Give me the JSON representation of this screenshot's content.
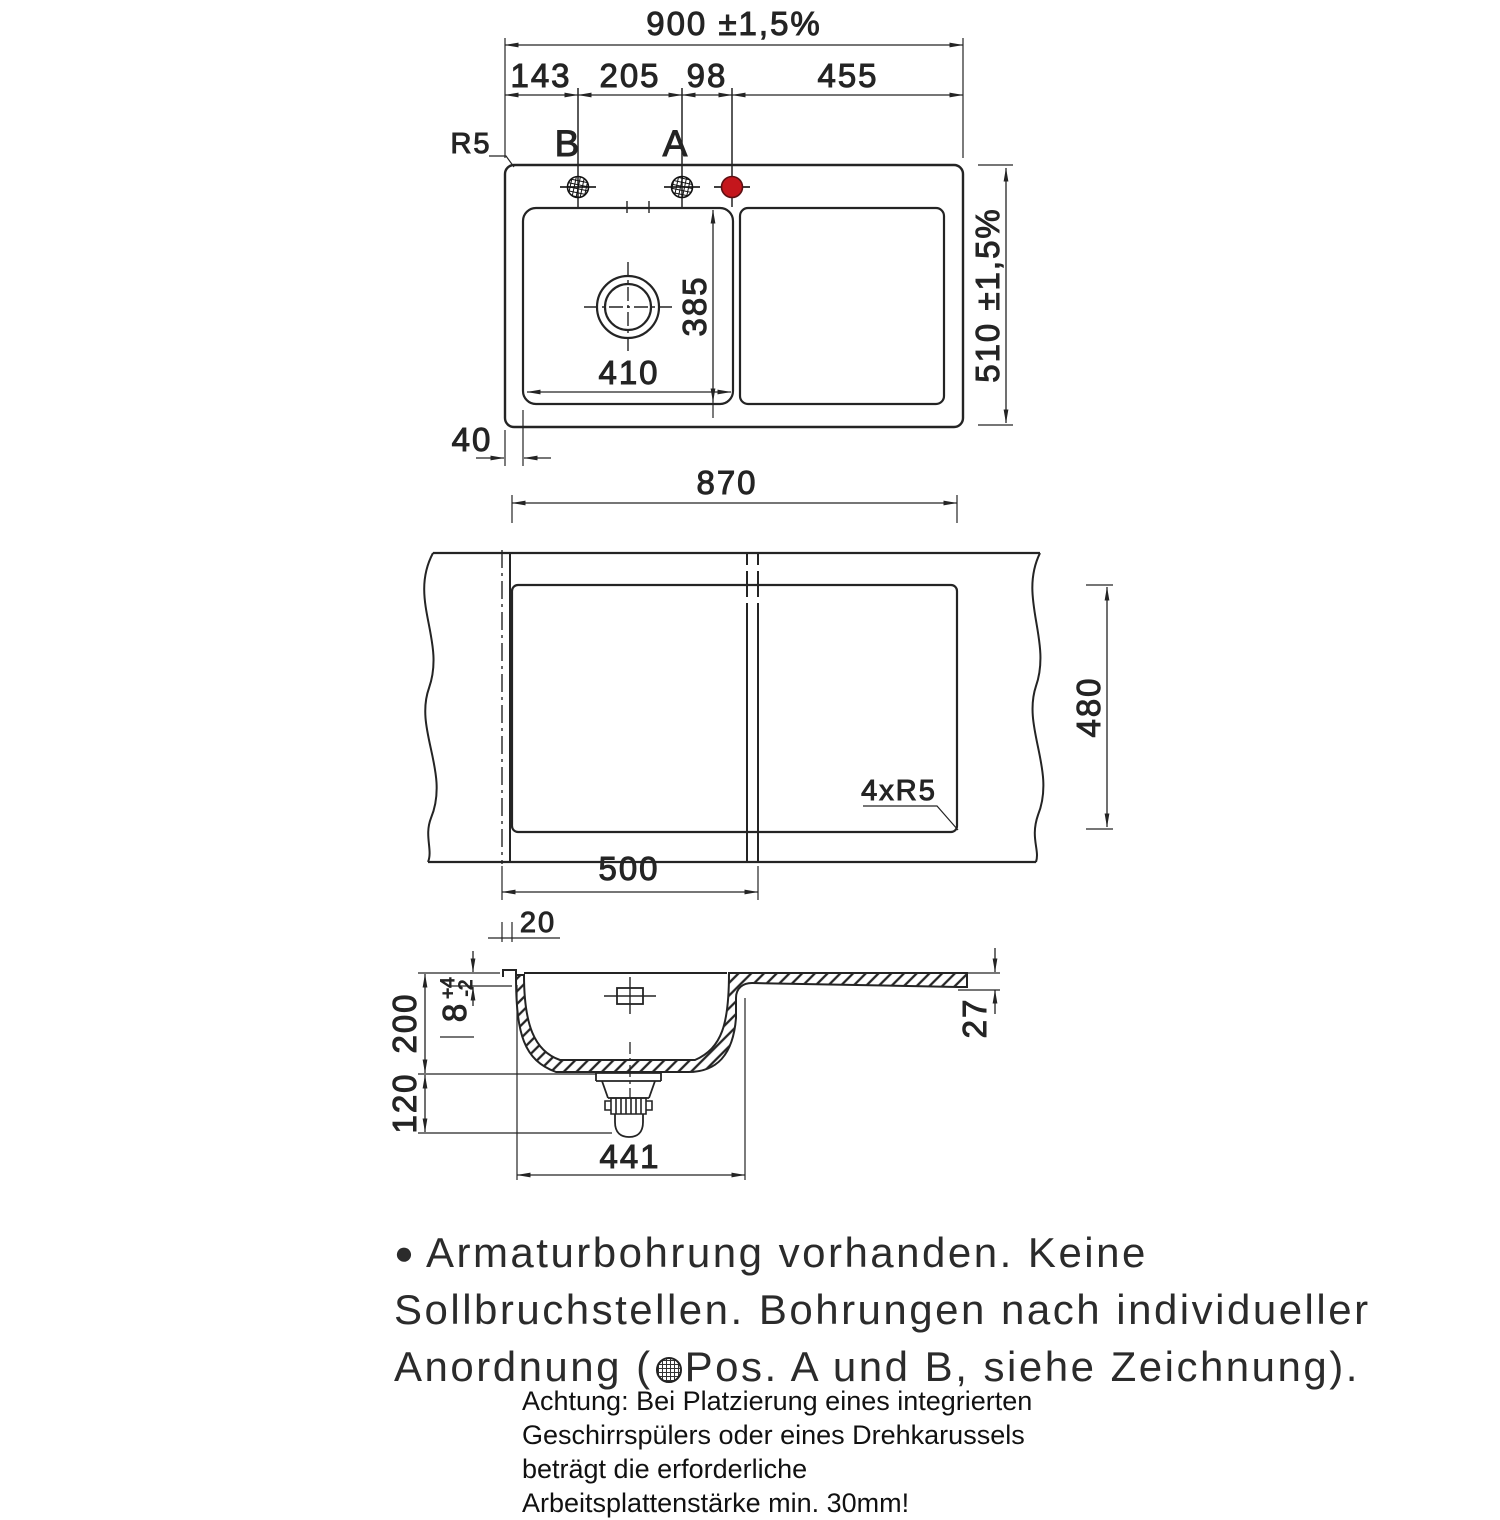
{
  "drawing": {
    "top_view": {
      "dim_overall_width": "900 ±1,5%",
      "dim_seg_1": "143",
      "dim_seg_2": "205",
      "dim_seg_3": "98",
      "dim_seg_4": "455",
      "label_radius": "R5",
      "label_hole_b": "B",
      "label_hole_a": "A",
      "dim_bowl_depth": "385",
      "dim_bowl_width": "410",
      "dim_overall_height": "510 ±1,5%",
      "dim_edge_offset": "40"
    },
    "cutout_view": {
      "dim_cutout_width": "870",
      "dim_cutout_height": "480",
      "label_corner_radius": "4xR5",
      "dim_left_width": "500",
      "dim_offset": "20"
    },
    "section_view": {
      "dim_depth": "200",
      "dim_rim": "8",
      "dim_rim_tol_plus": "+4",
      "dim_rim_tol_minus": "-2",
      "dim_below": "120",
      "dim_bowl_outer": "441",
      "dim_board_thickness": "27"
    },
    "notes": {
      "bullet": "●",
      "line_1": "Armaturbohrung vorhanden. Keine",
      "line_2": "Sollbruchstellen. Bohrungen nach individueller",
      "line_3_pre": "Anordnung (",
      "line_3_post": "Pos. A und B, siehe Zeichnung)."
    },
    "warning": {
      "line_1": "Achtung: Bei Platzierung eines integrierten",
      "line_2": "Geschirrspülers oder eines Drehkarussels",
      "line_3": "beträgt die erforderliche",
      "line_4": "Arbeitsplattenstärke min. 30mm!"
    },
    "colors": {
      "line": "#242424",
      "hole_marker_red": "#c4161c"
    }
  }
}
